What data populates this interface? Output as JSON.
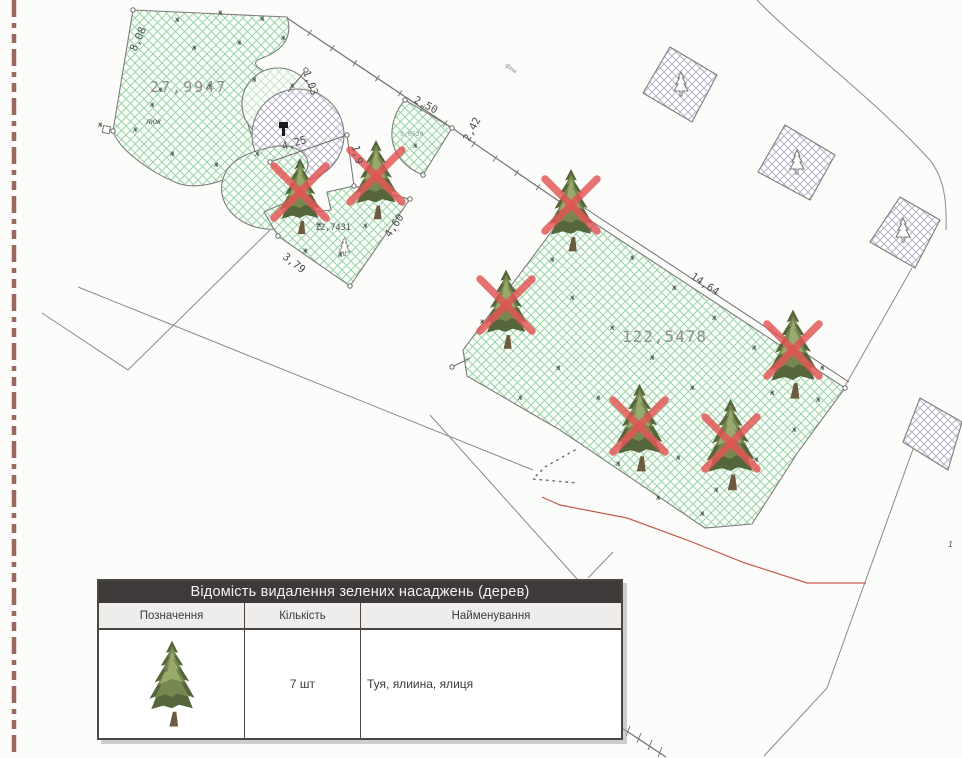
{
  "plan": {
    "area_labels": {
      "left_bed": "27,9947",
      "fan_bed": "5,0529",
      "middle_bed": "12,7431",
      "main_lawn": "122,5478"
    },
    "dimensions": {
      "left_edge": "8,08",
      "circle_leader": "1,03",
      "circle_width": "4,25",
      "circle_drop": "1,9",
      "fan_top": "2,50",
      "fan_right": "2,42",
      "bed_left": "3,79",
      "bed_right": "4,60",
      "lawn_top": "14,64"
    },
    "annotations": {
      "manhole": "люк",
      "pavement": "фем",
      "parcel_number": "1"
    }
  },
  "legend_table": {
    "title": "Відомість видалення зелених насаджень (дерев)",
    "columns": [
      "Позначення",
      "Кількість",
      "Найменування"
    ],
    "rows": [
      {
        "symbol": "conifer-tree",
        "quantity": "7 шт",
        "name": "Туя, ялиина, ялиця"
      }
    ]
  },
  "icons": {
    "grass_mark": "ж"
  },
  "colors": {
    "lawn_hatch": "#9cd2a4",
    "paving_hatch": "#b7b4c8",
    "removal_x": "#e25555",
    "red_boundary": "#c65a4e",
    "dashed_boundary": "#9c675f",
    "line": "#8a8a8a",
    "dim_text": "#4f4f4f",
    "area_text": "#8f8f8f"
  }
}
